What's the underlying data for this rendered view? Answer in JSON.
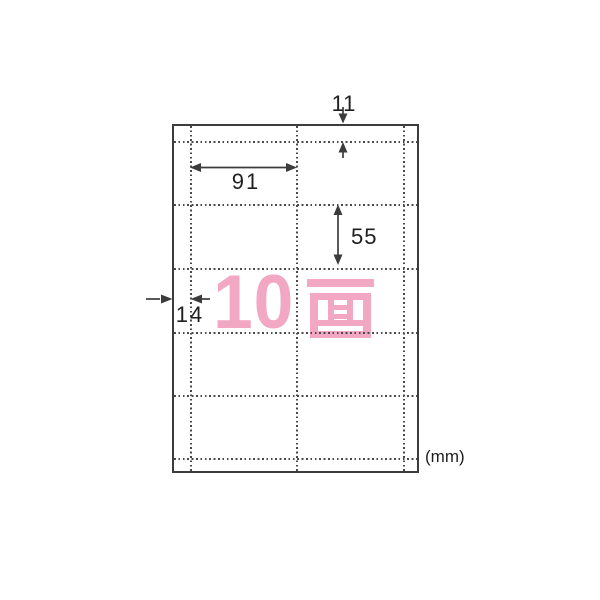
{
  "diagram": {
    "type": "label-sheet-dimension-diagram",
    "face_count_overlay": {
      "digits": "10",
      "kanji": "面",
      "full_text": "10面"
    },
    "unit_label": "(mm)",
    "dimensions": {
      "top_margin": "11",
      "card_width": "91",
      "card_height": "55",
      "left_margin": "14"
    },
    "grid": {
      "columns": 2,
      "rows": 5,
      "faces": 10
    }
  },
  "colors": {
    "outline": "#3c3c3c",
    "perforation_dots": "#4a4a4a",
    "dimension_text": "#1f1f1f",
    "accent_pink": "#f2a7c3"
  }
}
